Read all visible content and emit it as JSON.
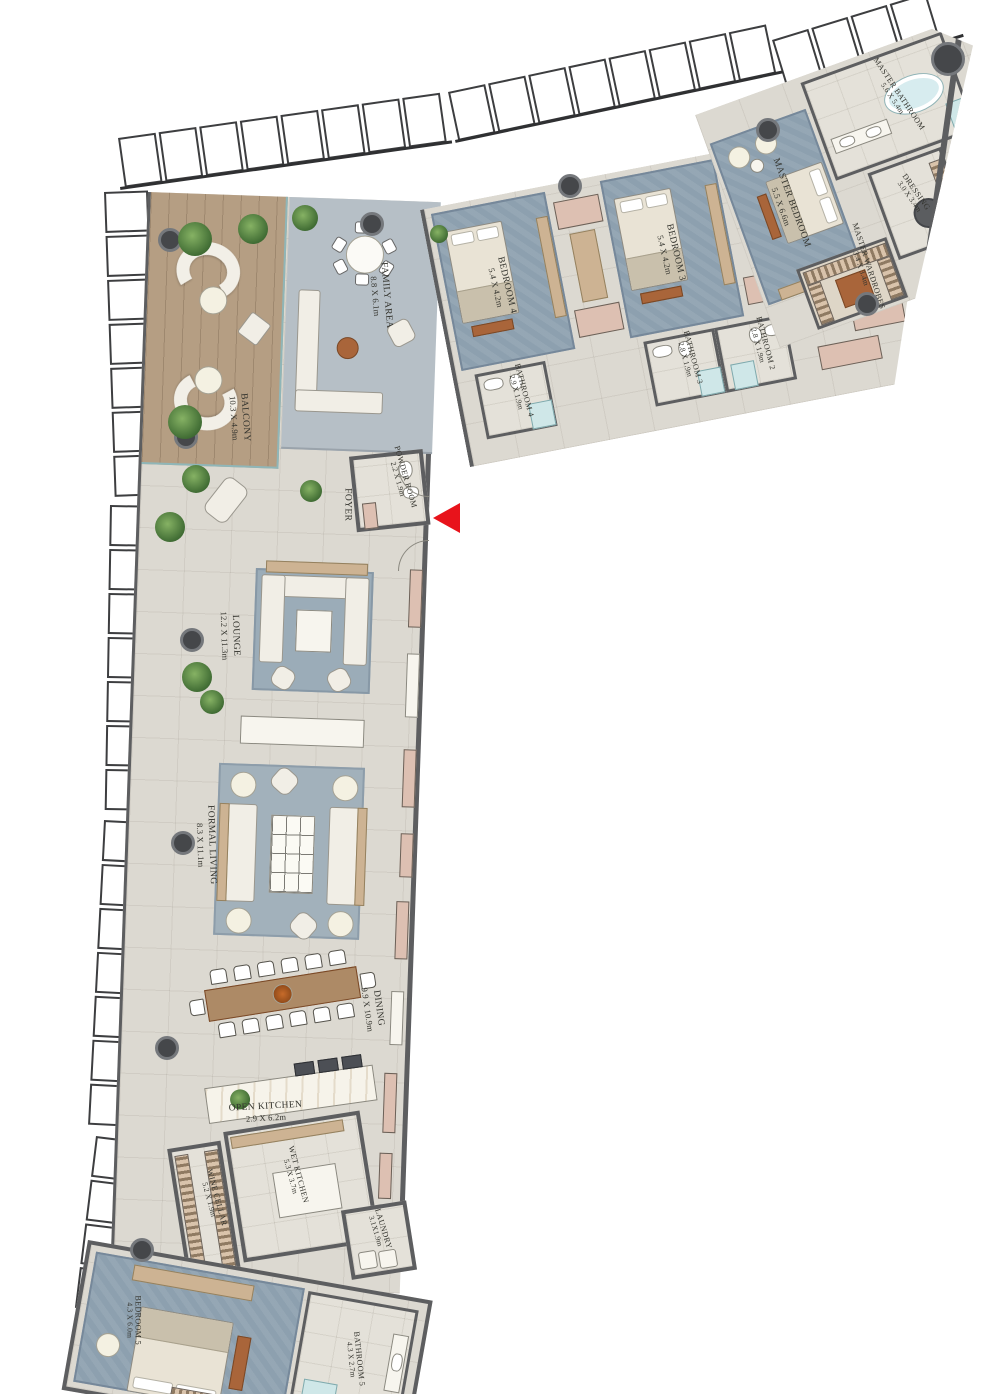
{
  "title": "Penthouse floor plan",
  "colors": {
    "wall": "#5d5e60",
    "floor": "#dcd9d1",
    "carpet": "#8da0af",
    "deck": "#b59e83",
    "entry_arrow": "#e8131b",
    "closet_pink": "#ddc0b2",
    "wood": "#a9653a",
    "glass": "#cfe7e8"
  },
  "rooms": {
    "balcony": {
      "name": "BALCONY",
      "dims": "10.3 X 4.9m"
    },
    "family": {
      "name": "FAMILY AREA",
      "dims": "8.8 X 6.1m"
    },
    "bedroom4": {
      "name": "BEDROOM 4",
      "dims": "5.4 X 4.2m"
    },
    "bathroom4": {
      "name": "BATHROOM 4",
      "dims": "2.9 X 1.9m"
    },
    "bedroom3": {
      "name": "BEDROOM 3",
      "dims": "5.4 X 4.2m"
    },
    "bathroom3": {
      "name": "BATHROOM 3",
      "dims": "2.8 X 1.9m"
    },
    "bathroom2": {
      "name": "BATHROOM 2",
      "dims": "2.8 X 1.9m"
    },
    "bedroom2": {
      "name": "BEDROOM 2",
      "dims": "5.4 X 4.2m"
    },
    "master_bedroom": {
      "name": "MASTER BEDROOM",
      "dims": "5.5 X 6.6m"
    },
    "master_wardrobes": {
      "name": "MASTER WARDROBES",
      "dims": "3.4 X 3.4m"
    },
    "master_bathroom": {
      "name": "MASTER BATHROOM",
      "dims": "5.6 X 5.4m"
    },
    "dressing": {
      "name": "DRESSING",
      "dims": "3.0 X 3.4m"
    },
    "powder": {
      "name": "POWDER ROOM",
      "dims": "2.2 X 1.9m"
    },
    "foyer": {
      "name": "FOYER",
      "dims": ""
    },
    "lounge": {
      "name": "LOUNGE",
      "dims": "12.2 X 11.3m"
    },
    "formal_living": {
      "name": "FORMAL LIVING",
      "dims": "8.3 X 11.1m"
    },
    "dining": {
      "name": "DINING",
      "dims": "9.9 X 10.9m"
    },
    "open_kitchen": {
      "name": "OPEN KITCHEN",
      "dims": "2.9 X 6.2m"
    },
    "wet_kitchen": {
      "name": "WET KITCHEN",
      "dims": "5.3 X 3.7m"
    },
    "wine_cellar": {
      "name": "WINE CELLAR",
      "dims": "5.2 X 1.9m"
    },
    "laundry": {
      "name": "LAUNDRY",
      "dims": "3.1X1.9m"
    },
    "bedroom5": {
      "name": "BEDROOM 5",
      "dims": "4.3 X 6.0m"
    },
    "bathroom5": {
      "name": "BATHROOM 5",
      "dims": "4.3 X 2.7m"
    }
  }
}
